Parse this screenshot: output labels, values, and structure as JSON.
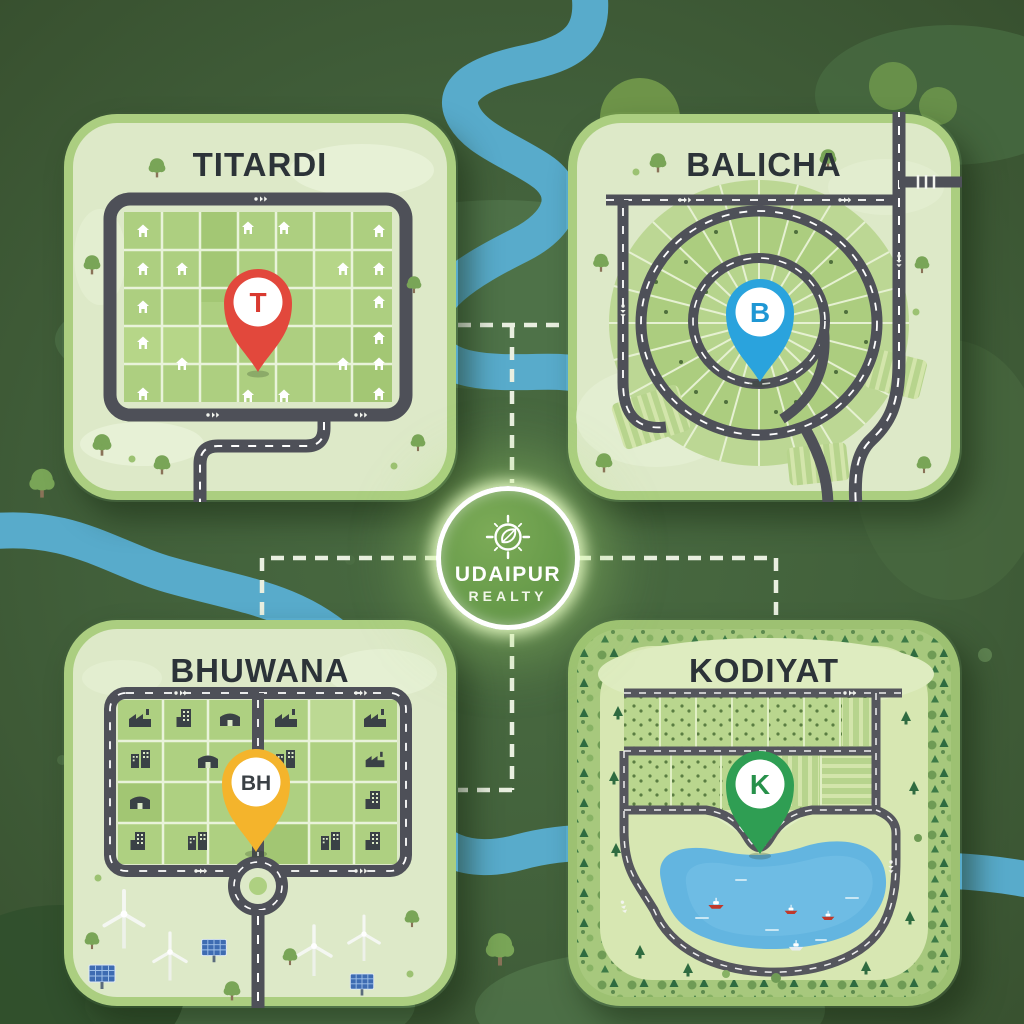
{
  "poster": {
    "brand_line1": "UDAIPUR",
    "brand_line2": "REALTY",
    "badge_icon": "compass-leaf-icon"
  },
  "cards": {
    "titardi": {
      "label": "TITARDI",
      "pin_letter": "T",
      "pin_color": "#e2483c",
      "letter_color": "#d93a30",
      "theme": "residential-plot-grid"
    },
    "balicha": {
      "label": "BALICHA",
      "pin_letter": "B",
      "pin_color": "#2aa3dd",
      "letter_color": "#1f97d4",
      "theme": "circular-plot-scheme"
    },
    "bhuwana": {
      "label": "BHUWANA",
      "pin_letter": "BH",
      "pin_color": "#f4b42c",
      "letter_color": "#3a4045",
      "theme": "industrial-grid-roundabout"
    },
    "kodiyat": {
      "label": "KODIYAT",
      "pin_letter": "K",
      "pin_color": "#2f9e53",
      "letter_color": "#27914a",
      "theme": "lake-forest-plots"
    }
  },
  "colors": {
    "background": "#41603b",
    "hills": "#50744a",
    "river": "#58abcb",
    "road": "#4e5058",
    "card_fill": "#dde9c8",
    "card_rim": "#a6c97c",
    "plot_green": "#adcf80",
    "title_text": "#2c3338",
    "connector_dash": "#e9efe0",
    "lake": "#63b5e0",
    "badge_green": "#699c4b"
  }
}
